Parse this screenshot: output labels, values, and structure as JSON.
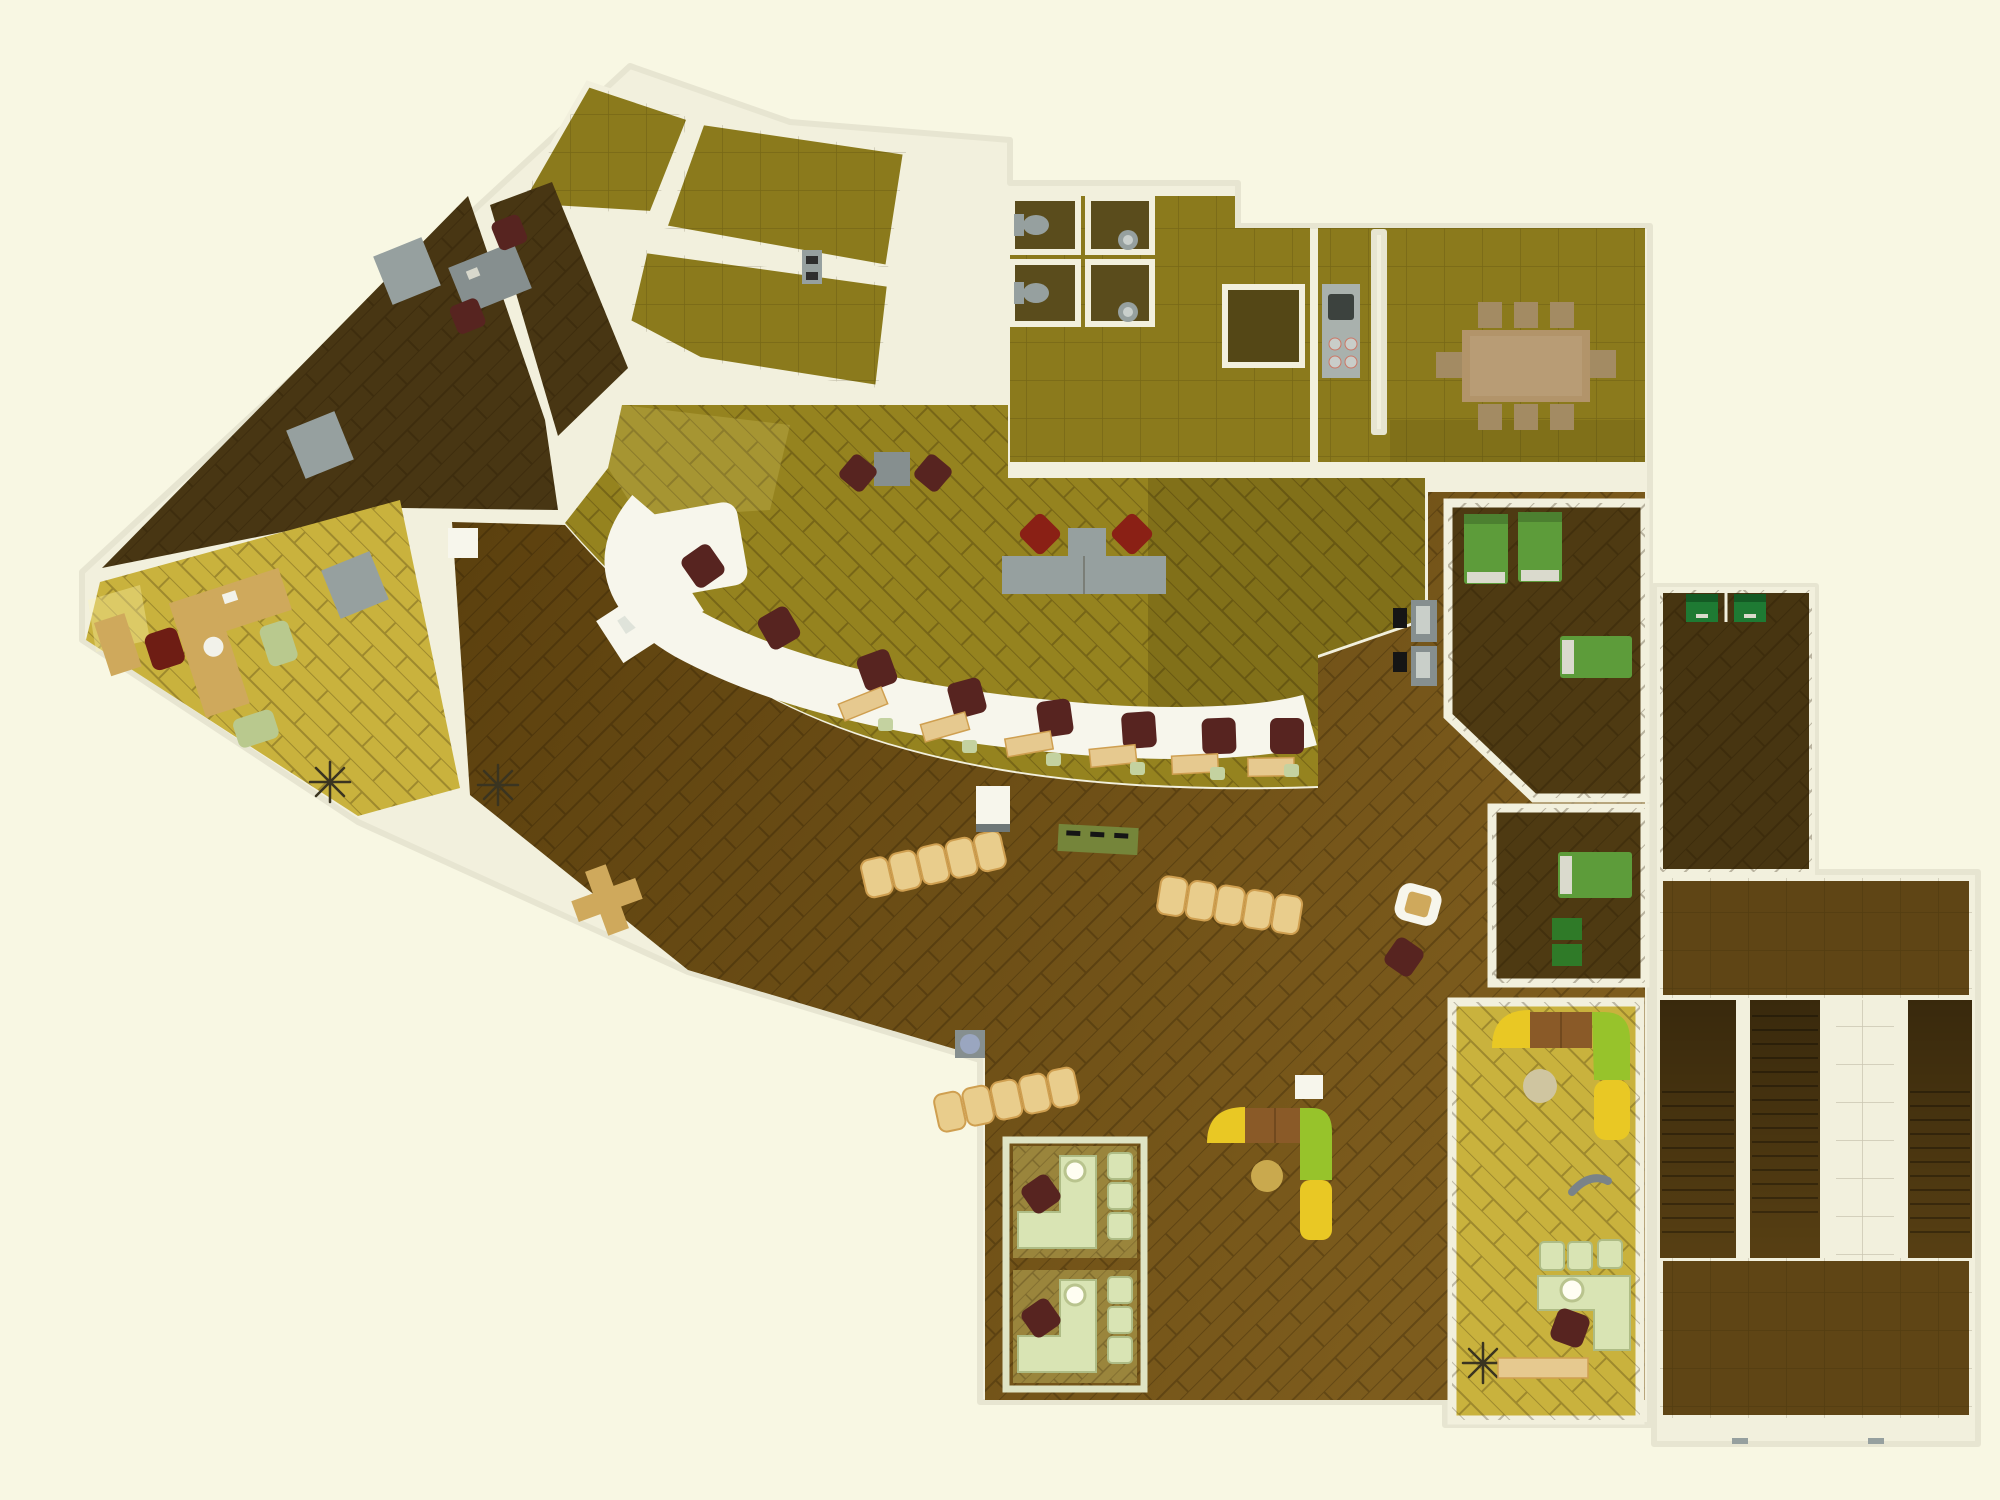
{
  "meta": {
    "label": "Top-down 3D rendered floor plan of an office / bank building with angled office wing, teller counter hall, conference room, WC stalls, rest rooms with beds, cubicle offices, lounge corners and a stairwell annex",
    "type": "architectural-floor-plan-render"
  },
  "colors": {
    "bg": "#f8f7e3",
    "wall": "#f2f0dd",
    "wallEdge": "#e7e5d1",
    "olive": "#8b7a1c",
    "oliveDark": "#5a4c1c",
    "oliveInset": "#544716",
    "teller": "#95831f",
    "lobbyA": "#5b400e",
    "lobbyB": "#7d5c1d",
    "darkRoom": "#483613",
    "bedFloor": "#4e3a12",
    "yellow": "#c9b23d",
    "cubFloor": "#9a853c",
    "annexRoom": "#473511",
    "annexHall": "#5f4515",
    "stairFloor": "#573f13",
    "white": "#f7f6ec",
    "paleGreen": "#d9e4b4",
    "paleGreenEdge": "#aebc85",
    "tan": "#cfa95c",
    "tanPanel": "#e6c98f",
    "bench": "#e9cd8c",
    "benchEdge": "#cf9f50",
    "maroon": "#572420",
    "red": "#8a2015",
    "gray": "#96a09f",
    "graySteel": "#868f8f",
    "grayDark": "#6f7878",
    "greenBed": "#5d9c3a",
    "pillowC": "#dadacd",
    "greenDesk": "#1e7a33",
    "sofaY": "#e9c824",
    "sofaG": "#97c32b",
    "sofaB": "#8a5a28",
    "gold": "#c9a94e",
    "beige": "#cfc5a0",
    "console": "#75853a",
    "confTable": "#b2946a",
    "confChair": "#a38b63",
    "plantC": "#3a3420",
    "matC": "#151515",
    "binC": "#9aa6c0",
    "toiletC": "#9aa0a0"
  },
  "rooms": [
    {
      "id": "angled-office-wing",
      "name": "Angled open-office wing (top-left, olive tiled rooms)"
    },
    {
      "id": "dark-meeting-room",
      "name": "Dark triangular meeting room with gray tables"
    },
    {
      "id": "executive-office",
      "name": "Executive office with desk, red chair, two guest chairs"
    },
    {
      "id": "teller-hall",
      "name": "Curved teller / service counter hall"
    },
    {
      "id": "lobby",
      "name": "Large brown public lobby with waiting benches"
    },
    {
      "id": "wc-block",
      "name": "Sanitary block: 2 toilet stalls + 2 sink stalls"
    },
    {
      "id": "kitchen-nook",
      "name": "Kitchenette with stove and sink"
    },
    {
      "id": "conference-room",
      "name": "Conference room, 8-seat table"
    },
    {
      "id": "rest-room-1",
      "name": "Rest room with three green beds"
    },
    {
      "id": "rest-room-2",
      "name": "Rest room with one green bed and two seats"
    },
    {
      "id": "lounge-room",
      "name": "Yellow lounge room with curved sectional sofa and L-desk"
    },
    {
      "id": "lobby-lounge-corner",
      "name": "Lobby lounge corner sofa with round gold table"
    },
    {
      "id": "cubicle-offices",
      "name": "Two consultation cubicles with L-desks"
    },
    {
      "id": "study-room",
      "name": "Annex room with two green study desks"
    },
    {
      "id": "stairwell",
      "name": "Stairwell annex with three flights"
    }
  ],
  "furniture": {
    "teller_chairs": 8,
    "client_panels": 6,
    "client_stools": 6,
    "bench_rows": 3,
    "bench_seats_per_row": 5,
    "conference_chairs": 8,
    "beds": 4,
    "toilets": 2,
    "sinks": 2,
    "cubicles": 2,
    "stair_flights": 3,
    "sectional_sofas": 2,
    "study_desks": 2,
    "plants": 3,
    "gray_wing_tables": 3
  }
}
